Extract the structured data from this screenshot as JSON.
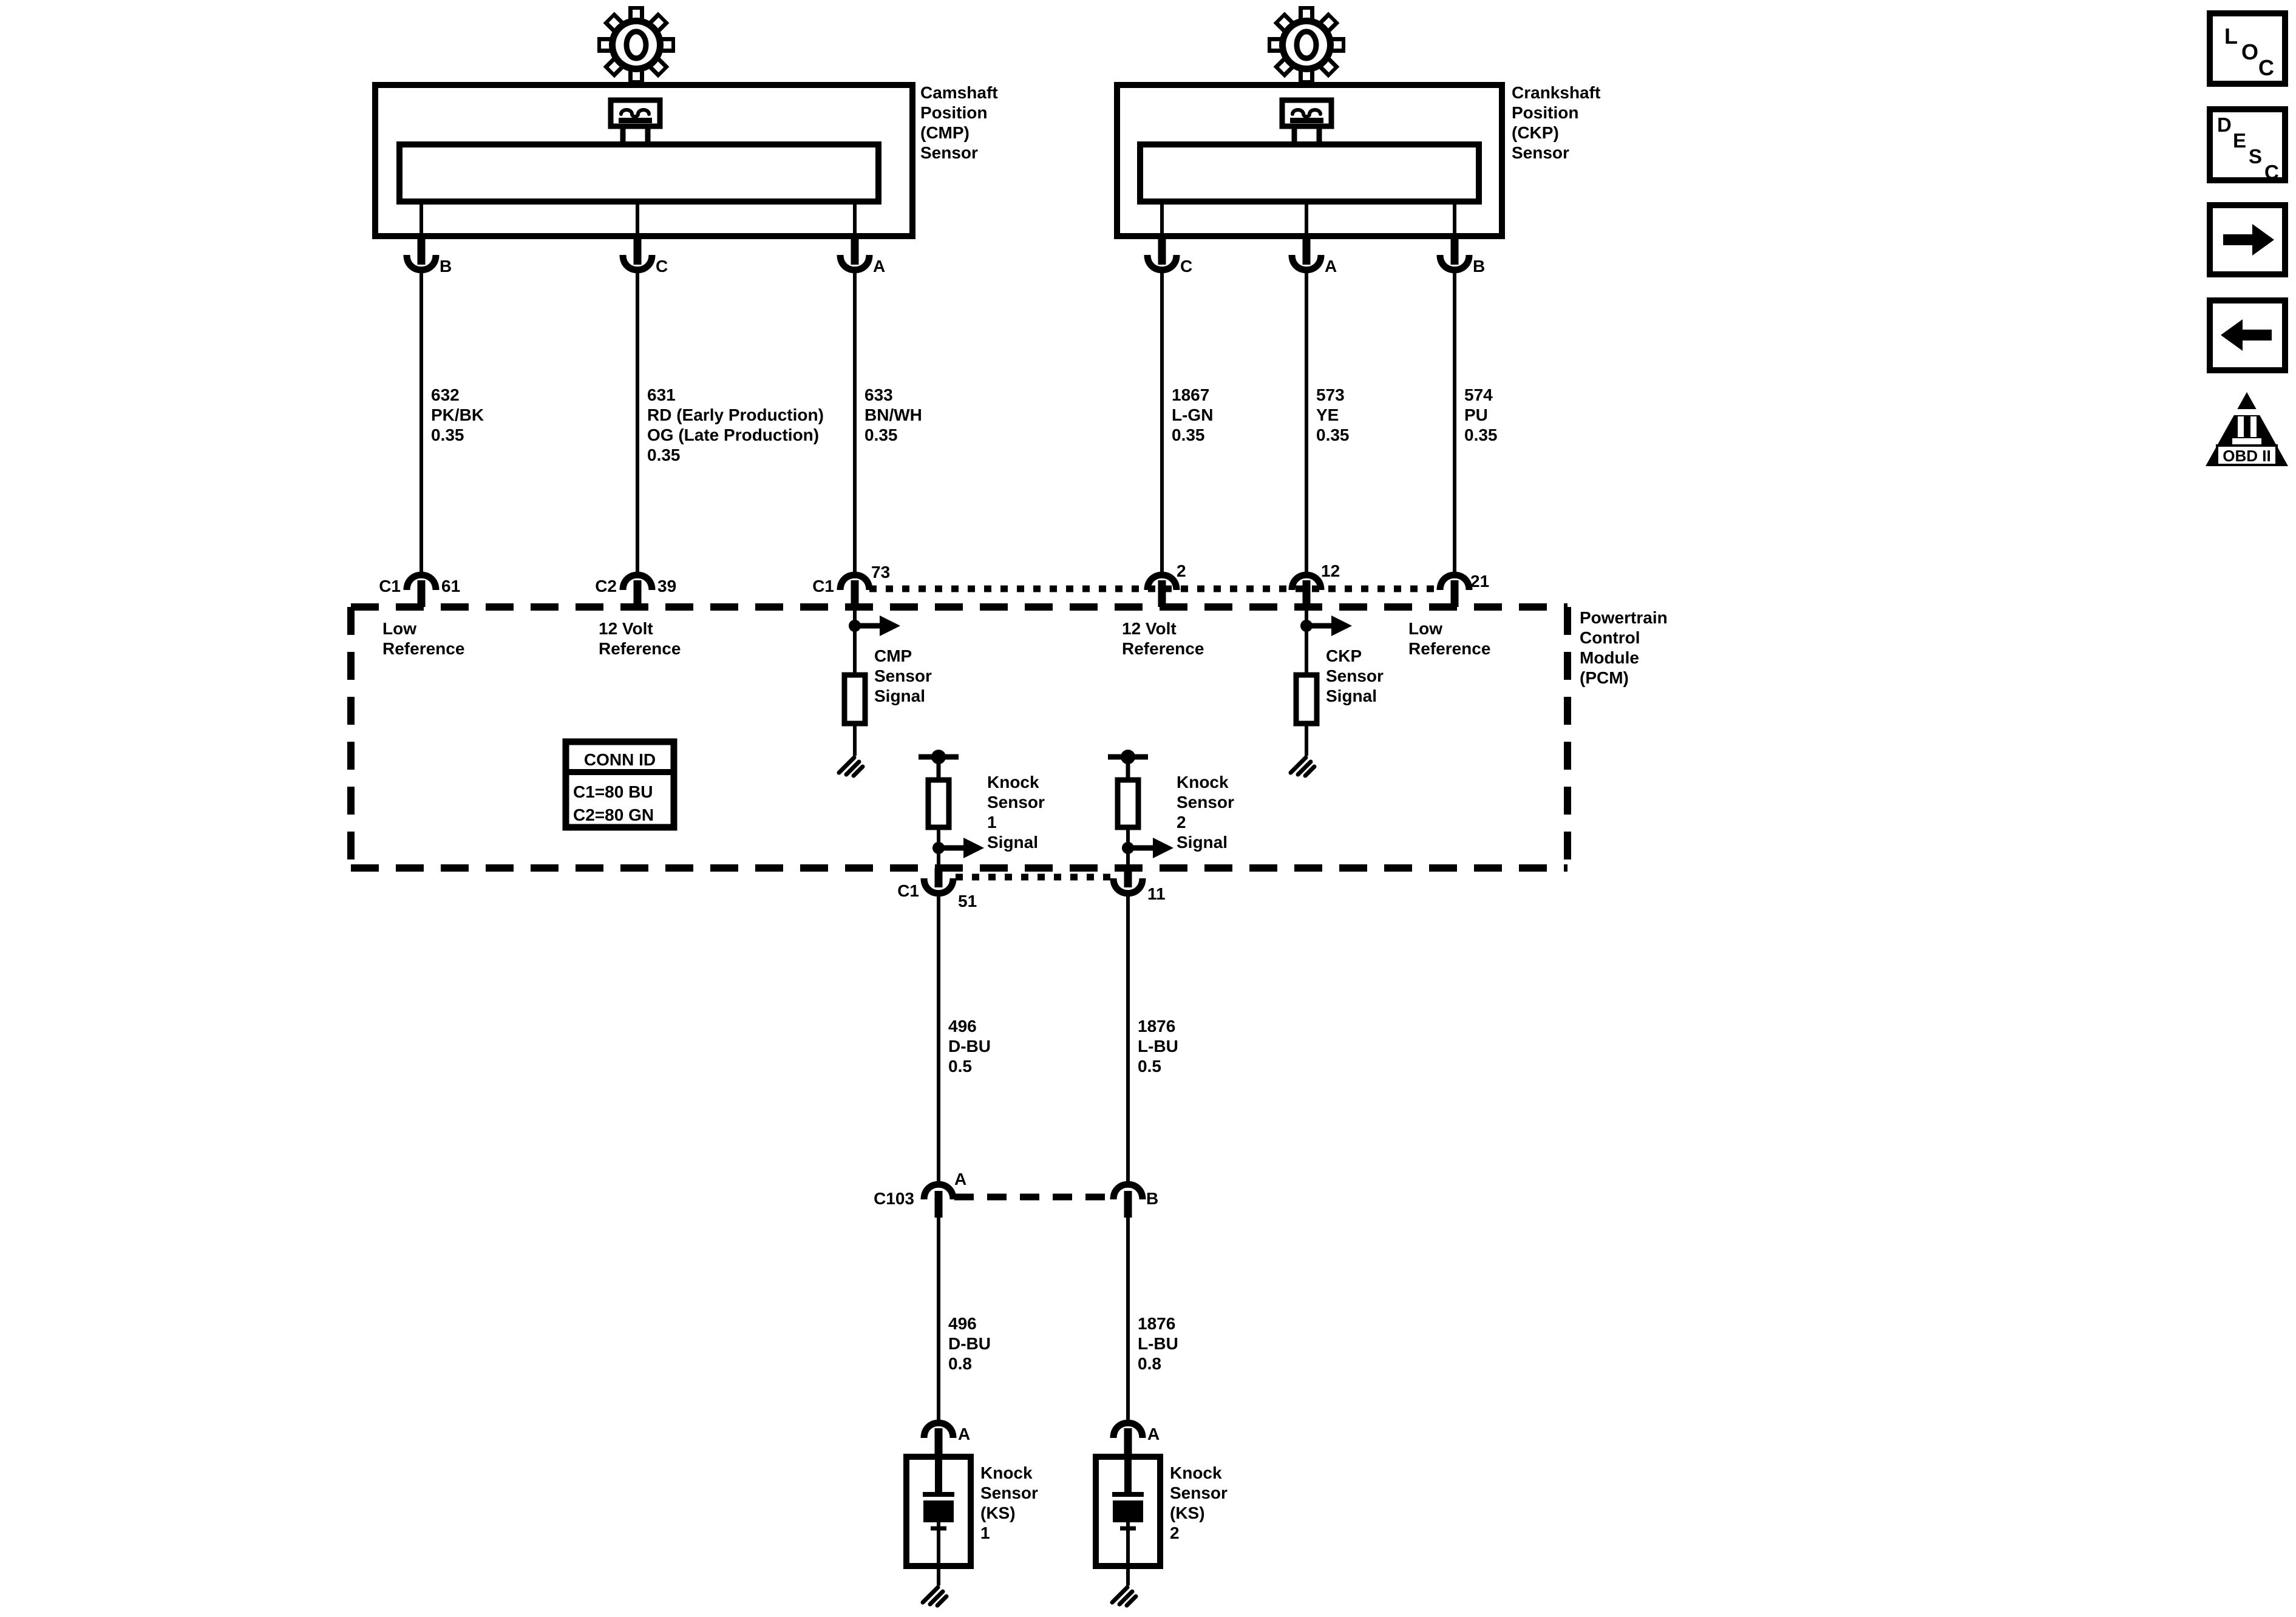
{
  "colors": {
    "ink": "#000000",
    "paper": "#ffffff"
  },
  "cmp_sensor": {
    "name_lines": [
      "Camshaft",
      "Position",
      "(CMP)",
      "Sensor"
    ],
    "pins": [
      "B",
      "C",
      "A"
    ],
    "wires": [
      {
        "lines": [
          "632",
          "PK/BK",
          "0.35"
        ]
      },
      {
        "lines": [
          "631",
          "RD (Early Production)",
          "OG (Late Production)",
          "0.35"
        ]
      },
      {
        "lines": [
          "633",
          "BN/WH",
          "0.35"
        ]
      }
    ],
    "pcm_terminals": [
      {
        "connector": "C1",
        "pin": "61"
      },
      {
        "connector": "C2",
        "pin": "39"
      },
      {
        "connector": "C1",
        "pin": "73"
      }
    ]
  },
  "ckp_sensor": {
    "name_lines": [
      "Crankshaft",
      "Position",
      "(CKP)",
      "Sensor"
    ],
    "pins": [
      "C",
      "A",
      "B"
    ],
    "wires": [
      {
        "lines": [
          "1867",
          "L-GN",
          "0.35"
        ]
      },
      {
        "lines": [
          "573",
          "YE",
          "0.35"
        ]
      },
      {
        "lines": [
          "574",
          "PU",
          "0.35"
        ]
      }
    ],
    "pcm_terminals": [
      "2",
      "12",
      "21"
    ]
  },
  "pcm": {
    "name_lines": [
      "Powertrain",
      "Control",
      "Module",
      "(PCM)"
    ],
    "low_ref_left": [
      "Low",
      "Reference"
    ],
    "v12_ref_left": [
      "12 Volt",
      "Reference"
    ],
    "cmp_signal": [
      "CMP",
      "Sensor",
      "Signal"
    ],
    "v12_ref_right": [
      "12 Volt",
      "Reference"
    ],
    "ckp_signal": [
      "CKP",
      "Sensor",
      "Signal"
    ],
    "low_ref_right": [
      "Low",
      "Reference"
    ],
    "ks1_signal": [
      "Knock",
      "Sensor",
      "1",
      "Signal"
    ],
    "ks2_signal": [
      "Knock",
      "Sensor",
      "2",
      "Signal"
    ],
    "conn_id": {
      "title": "CONN ID",
      "rows": [
        "C1=80 BU",
        "C2=80 GN"
      ]
    },
    "lower_terminals": {
      "connector": "C1",
      "pin1": "51",
      "pin2": "11"
    }
  },
  "knock_circuit": {
    "upper_wires": [
      {
        "lines": [
          "496",
          "D-BU",
          "0.5"
        ]
      },
      {
        "lines": [
          "1876",
          "L-BU",
          "0.5"
        ]
      }
    ],
    "c103": {
      "label": "C103",
      "pin_a": "A",
      "pin_b": "B"
    },
    "lower_wires": [
      {
        "lines": [
          "496",
          "D-BU",
          "0.8"
        ]
      },
      {
        "lines": [
          "1876",
          "L-BU",
          "0.8"
        ]
      }
    ],
    "sensors": [
      {
        "pin": "A",
        "name_lines": [
          "Knock",
          "Sensor",
          "(KS)",
          "1"
        ]
      },
      {
        "pin": "A",
        "name_lines": [
          "Knock",
          "Sensor",
          "(KS)",
          "2"
        ]
      }
    ]
  },
  "sidebar": {
    "loc_letters": [
      "L",
      "O",
      "C"
    ],
    "desc_letters": [
      "D",
      "E",
      "S",
      "C"
    ],
    "obd_label": "OBD II"
  }
}
